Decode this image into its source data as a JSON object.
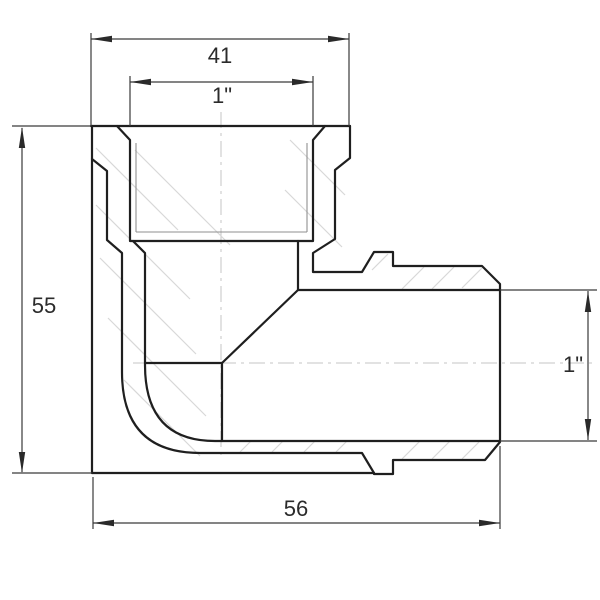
{
  "drawing": {
    "title": "Section view of 90-degree threaded elbow pipe fitting",
    "type": "technical-dimension-drawing",
    "canvas": {
      "width": 600,
      "height": 600
    },
    "dimensions": [
      {
        "id": "socket-outer-width-top",
        "label": "41",
        "orientation": "horizontal"
      },
      {
        "id": "socket-thread-size-top",
        "label": "1\"",
        "orientation": "horizontal"
      },
      {
        "id": "overall-height-left",
        "label": "55",
        "orientation": "vertical"
      },
      {
        "id": "male-thread-size-right",
        "label": "1\"",
        "orientation": "vertical"
      },
      {
        "id": "overall-length-bottom",
        "label": "56",
        "orientation": "horizontal"
      }
    ],
    "colors": {
      "background": "#ffffff",
      "outline": "#1f1f1f",
      "dimension": "#3a3a3a",
      "thread_thin": "#8f8f8f",
      "centerline": "#c4c4c4",
      "hatch": "#d8d8d8",
      "text": "#2b2b2b"
    }
  }
}
